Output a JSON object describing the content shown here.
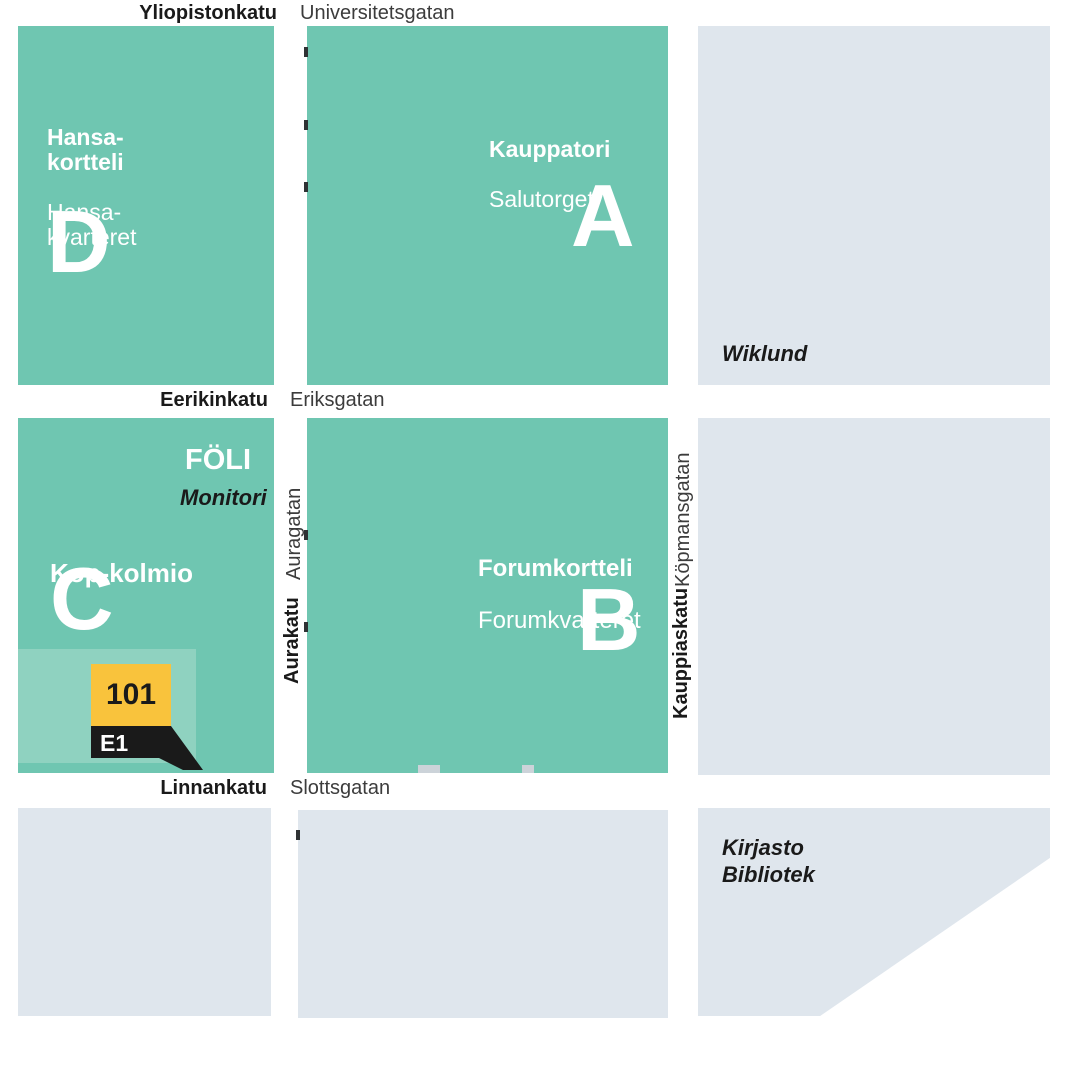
{
  "streets": {
    "top": {
      "fi": "Yliopistonkatu",
      "sv": "Universitetsgatan"
    },
    "middle": {
      "fi": "Eerikinkatu",
      "sv": "Eriksgatan"
    },
    "bottom": {
      "fi": "Linnankatu",
      "sv": "Slottsgatan"
    },
    "vertical_left": {
      "fi": "Aurakatu",
      "sv": "Auragatan"
    },
    "vertical_right": {
      "fi": "Kauppiaskatu",
      "sv": "Köpmansgatan"
    }
  },
  "blocks": {
    "hansa": {
      "letter": "D",
      "name_fi": "Hansa-\nkortteli",
      "name_sv": "Hansa-\nkvarteret"
    },
    "kauppatori": {
      "letter": "A",
      "name_fi": "Kauppatori",
      "name_sv": "Salutorget"
    },
    "forum": {
      "letter": "B",
      "name_fi": "Forumkortteli",
      "name_sv": "Forumkvarteret"
    },
    "kop": {
      "letter": "C",
      "name_fi": "Kop-kolmio",
      "logo": "FÖLI",
      "logo_caption": "Monitori"
    },
    "wiklund": {
      "label": "Wiklund"
    },
    "library": {
      "label_fi": "Kirjasto",
      "label_sv": "Bibliotek"
    }
  },
  "marker": {
    "stop_number": "101",
    "entrance_code": "E1"
  },
  "colors": {
    "block_teal": "#6FC6B1",
    "block_teal_light": "#8FD2C0",
    "block_gray": "#DFE6ED",
    "marker_yellow": "#F9C33C",
    "marker_black": "#1A1A1A",
    "text_dark": "#1A1A1A",
    "text_muted": "#3C3C3C",
    "text_white": "#FFFFFF"
  }
}
